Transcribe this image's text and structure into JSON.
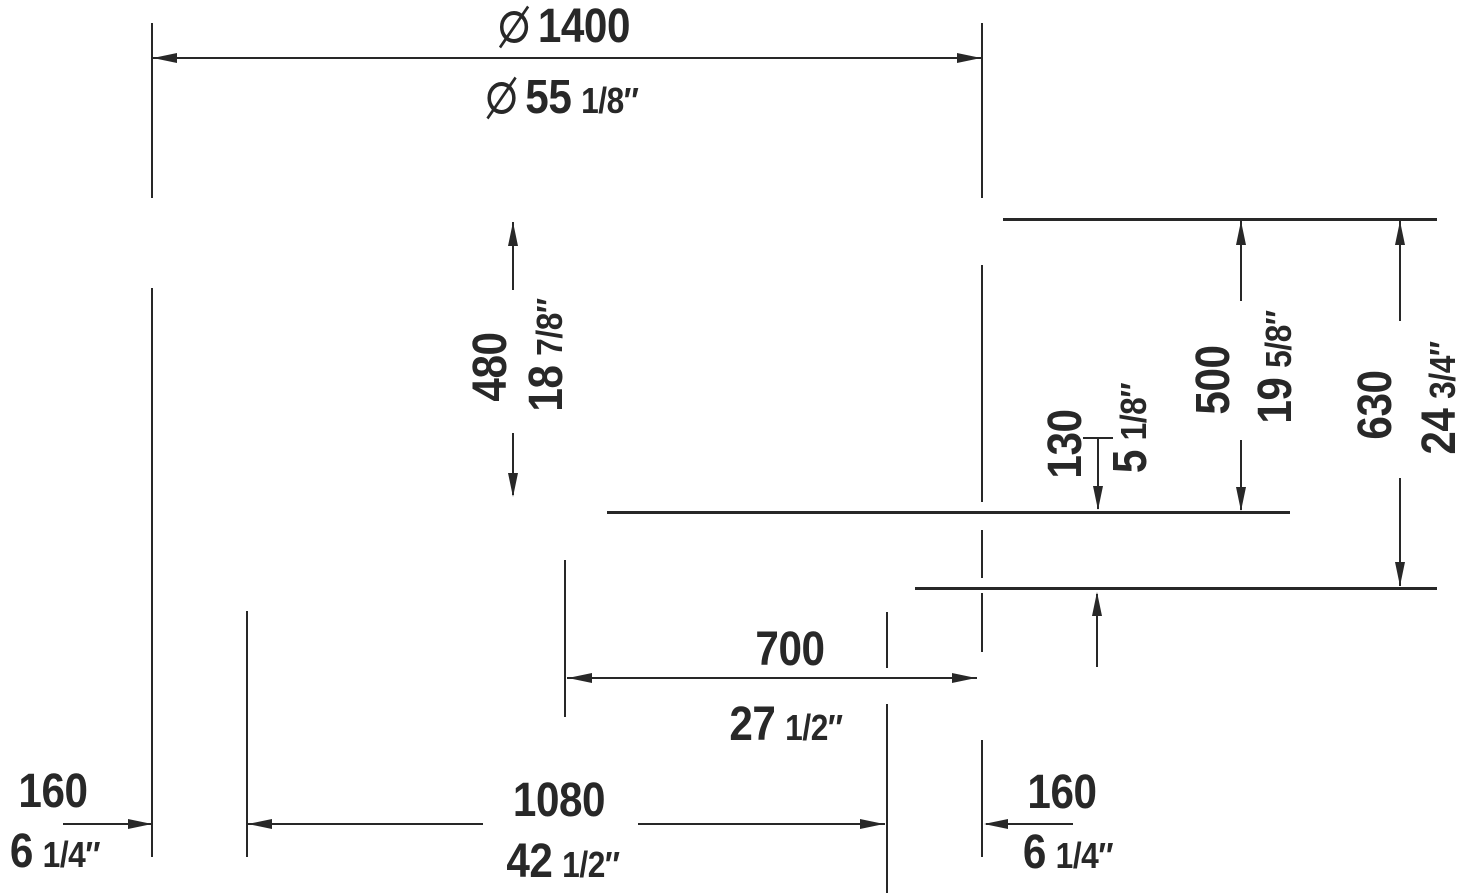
{
  "colors": {
    "ink": "#282828",
    "background": "#ffffff"
  },
  "dimensions": {
    "diameter": {
      "metric": "1400",
      "imperial_main": "55",
      "imperial_frac": "1/8″"
    },
    "inner_depth": {
      "metric": "480",
      "imperial_main": "18",
      "imperial_frac": "7/8″"
    },
    "base_clearance": {
      "metric": "130",
      "imperial_main": "5",
      "imperial_frac": "1/8″"
    },
    "rim_to_skirt": {
      "metric": "500",
      "imperial_main": "19",
      "imperial_frac": "5/8″"
    },
    "overall_height": {
      "metric": "630",
      "imperial_main": "24",
      "imperial_frac": "3/4″"
    },
    "center_to_edge": {
      "metric": "700",
      "imperial_main": "27",
      "imperial_frac": "1/2″"
    },
    "foot_span": {
      "metric": "1080",
      "imperial_main": "42",
      "imperial_frac": "1/2″"
    },
    "left_foot_offset": {
      "metric": "160",
      "imperial_main": "6",
      "imperial_frac": "1/4″"
    },
    "right_foot_offset": {
      "metric": "160",
      "imperial_main": "6",
      "imperial_frac": "1/4″"
    }
  },
  "drawing": {
    "lines": [
      {
        "n": "dim-line-diameter",
        "x": 152,
        "y": 57,
        "w": 830,
        "h": 2
      },
      {
        "n": "rim-level-line",
        "x": 1003,
        "y": 218,
        "w": 434,
        "h": 3
      },
      {
        "n": "skirt-level-line",
        "x": 607,
        "y": 511,
        "w": 683,
        "h": 3
      },
      {
        "n": "floor-level-line",
        "x": 915,
        "y": 587,
        "w": 522,
        "h": 3
      },
      {
        "n": "dim-line-center-to-edge",
        "x": 567,
        "y": 677,
        "w": 410,
        "h": 2
      },
      {
        "n": "dim-line-left-offset",
        "x": 63,
        "y": 823,
        "w": 88,
        "h": 2
      },
      {
        "n": "dim-line-foot-span-left",
        "x": 247,
        "y": 823,
        "w": 236,
        "h": 2
      },
      {
        "n": "dim-line-foot-span-right",
        "x": 638,
        "y": 823,
        "w": 247,
        "h": 2
      },
      {
        "n": "dim-line-right-offset",
        "x": 986,
        "y": 823,
        "w": 87,
        "h": 2
      },
      {
        "n": "clearance-top-tick",
        "x": 1083,
        "y": 437,
        "w": 30,
        "h": 2
      },
      {
        "n": "extension-line-left-upper",
        "x": 151,
        "y": 23,
        "w": 2,
        "h": 175
      },
      {
        "n": "extension-line-left-lower",
        "x": 151,
        "y": 288,
        "w": 2,
        "h": 569
      },
      {
        "n": "extension-line-right-1",
        "x": 981,
        "y": 23,
        "w": 2,
        "h": 175
      },
      {
        "n": "extension-line-right-2",
        "x": 981,
        "y": 265,
        "w": 2,
        "h": 237
      },
      {
        "n": "extension-line-right-3",
        "x": 981,
        "y": 530,
        "w": 2,
        "h": 48
      },
      {
        "n": "extension-line-right-4",
        "x": 981,
        "y": 593,
        "w": 2,
        "h": 59
      },
      {
        "n": "extension-line-right-5",
        "x": 981,
        "y": 740,
        "w": 2,
        "h": 117
      },
      {
        "n": "left-foot-line",
        "x": 246,
        "y": 611,
        "w": 2,
        "h": 246
      },
      {
        "n": "right-foot-line-upper",
        "x": 886,
        "y": 612,
        "w": 2,
        "h": 56
      },
      {
        "n": "right-foot-line-lower",
        "x": 886,
        "y": 704,
        "w": 2,
        "h": 189
      },
      {
        "n": "center-line",
        "x": 564,
        "y": 560,
        "w": 2,
        "h": 157
      },
      {
        "n": "dim-line-depth-upper",
        "x": 512,
        "y": 222,
        "w": 2,
        "h": 68
      },
      {
        "n": "dim-line-depth-lower",
        "x": 512,
        "y": 433,
        "w": 2,
        "h": 62
      },
      {
        "n": "dim-line-rim-upper",
        "x": 1240,
        "y": 221,
        "w": 2,
        "h": 80
      },
      {
        "n": "dim-line-rim-lower",
        "x": 1240,
        "y": 440,
        "w": 2,
        "h": 70
      },
      {
        "n": "dim-line-height-upper",
        "x": 1399,
        "y": 221,
        "w": 2,
        "h": 100
      },
      {
        "n": "dim-line-height-lower",
        "x": 1399,
        "y": 478,
        "w": 2,
        "h": 108
      },
      {
        "n": "dim-line-clearance-upper",
        "x": 1097,
        "y": 437,
        "w": 2,
        "h": 72
      },
      {
        "n": "dim-line-clearance-lower",
        "x": 1096,
        "y": 594,
        "w": 2,
        "h": 73
      }
    ],
    "arrows": [
      {
        "n": "arrowhead",
        "d": "left",
        "x": 153,
        "y": 58
      },
      {
        "n": "arrowhead",
        "d": "right",
        "x": 981,
        "y": 58
      },
      {
        "n": "arrowhead",
        "d": "up",
        "x": 513,
        "y": 222
      },
      {
        "n": "arrowhead",
        "d": "down",
        "x": 513,
        "y": 497
      },
      {
        "n": "arrowhead",
        "d": "up",
        "x": 1241,
        "y": 221
      },
      {
        "n": "arrowhead",
        "d": "down",
        "x": 1241,
        "y": 511
      },
      {
        "n": "arrowhead",
        "d": "up",
        "x": 1400,
        "y": 221
      },
      {
        "n": "arrowhead",
        "d": "down",
        "x": 1400,
        "y": 586
      },
      {
        "n": "arrowhead",
        "d": "down",
        "x": 1098,
        "y": 510
      },
      {
        "n": "arrowhead",
        "d": "up",
        "x": 1097,
        "y": 592
      },
      {
        "n": "arrowhead",
        "d": "left",
        "x": 568,
        "y": 678
      },
      {
        "n": "arrowhead",
        "d": "right",
        "x": 976,
        "y": 678
      },
      {
        "n": "arrowhead",
        "d": "right",
        "x": 152,
        "y": 824
      },
      {
        "n": "arrowhead",
        "d": "left",
        "x": 248,
        "y": 824
      },
      {
        "n": "arrowhead",
        "d": "right",
        "x": 884,
        "y": 824
      },
      {
        "n": "arrowhead",
        "d": "left",
        "x": 984,
        "y": 824
      }
    ]
  }
}
